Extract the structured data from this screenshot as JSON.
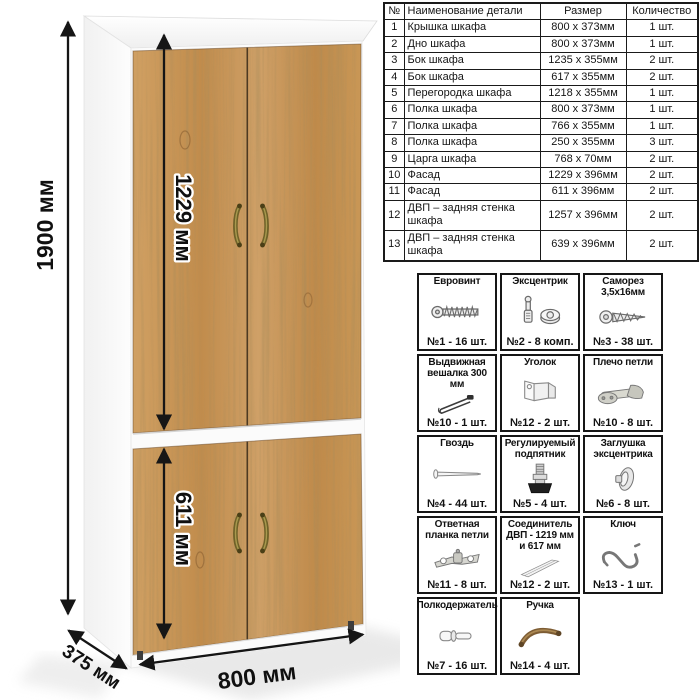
{
  "dimensions": {
    "height": "1900 мм",
    "width": "800 мм",
    "depth": "375 мм",
    "upper_facade": "1229 мм",
    "lower_facade": "611 мм"
  },
  "parts_table": {
    "headers": [
      "№",
      "Наименование детали",
      "Размер",
      "Количество"
    ],
    "rows": [
      {
        "num": "1",
        "name": "Крышка шкафа",
        "size": "800 х 373мм",
        "qty": "1 шт."
      },
      {
        "num": "2",
        "name": "Дно шкафа",
        "size": "800 х 373мм",
        "qty": "1 шт."
      },
      {
        "num": "3",
        "name": "Бок шкафа",
        "size": "1235 х 355мм",
        "qty": "2 шт."
      },
      {
        "num": "4",
        "name": "Бок шкафа",
        "size": "617 х 355мм",
        "qty": "2 шт."
      },
      {
        "num": "5",
        "name": "Перегородка шкафа",
        "size": "1218 х 355мм",
        "qty": "1 шт."
      },
      {
        "num": "6",
        "name": "Полка шкафа",
        "size": "800 х 373мм",
        "qty": "1 шт."
      },
      {
        "num": "7",
        "name": "Полка шкафа",
        "size": "766 х 355мм",
        "qty": "1 шт."
      },
      {
        "num": "8",
        "name": "Полка шкафа",
        "size": "250 х 355мм",
        "qty": "3 шт."
      },
      {
        "num": "9",
        "name": "Царга шкафа",
        "size": "768 х 70мм",
        "qty": "2 шт."
      },
      {
        "num": "10",
        "name": "Фасад",
        "size": "1229 х 396мм",
        "qty": "2 шт."
      },
      {
        "num": "11",
        "name": "Фасад",
        "size": "611 х 396мм",
        "qty": "2 шт."
      },
      {
        "num": "12",
        "name": "ДВП – задняя стенка шкафа",
        "size": "1257 х 396мм",
        "qty": "2 шт."
      },
      {
        "num": "13",
        "name": "ДВП – задняя стенка шкафа",
        "size": "639 х 396мм",
        "qty": "2 шт."
      }
    ]
  },
  "hardware": {
    "items": [
      {
        "name": "Евровинт",
        "count": "№1 - 16 шт.",
        "icon": "euro-screw-icon"
      },
      {
        "name": "Эксцентрик",
        "count": "№2 - 8 комп.",
        "icon": "cam-lock-icon"
      },
      {
        "name": "Саморез 3,5х16мм",
        "count": "№3 - 38 шт.",
        "icon": "self-tapping-screw-icon"
      },
      {
        "name": "Выдвижная вешалка 300 мм",
        "count": "№10 - 1 шт.",
        "icon": "pull-out-hanger-icon"
      },
      {
        "name": "Уголок",
        "count": "№12 - 2 шт.",
        "icon": "corner-bracket-icon"
      },
      {
        "name": "Плечо петли",
        "count": "№10 - 8 шт.",
        "icon": "hinge-arm-icon"
      },
      {
        "name": "Гвоздь",
        "count": "№4 - 44 шт.",
        "icon": "nail-icon"
      },
      {
        "name": "Регулируемый подпятник",
        "count": "№5 - 4 шт.",
        "icon": "adjustable-foot-icon"
      },
      {
        "name": "Заглушка эксцентрика",
        "count": "№6 - 8 шт.",
        "icon": "cam-cap-icon"
      },
      {
        "name": "Ответная планка петли",
        "count": "№11 - 8 шт.",
        "icon": "hinge-plate-icon"
      },
      {
        "name": "Соединитель ДВП - 1219 мм и 617 мм",
        "count": "№12 - 2 шт.",
        "icon": "hdf-connector-icon"
      },
      {
        "name": "Ключ",
        "count": "№13 - 1 шт.",
        "icon": "hex-key-icon"
      },
      {
        "name": "Полкодержатель",
        "count": "№7 - 16 шт.",
        "icon": "shelf-pin-icon"
      },
      {
        "name": "Ручка",
        "count": "№14 - 4 шт.",
        "icon": "handle-icon"
      }
    ]
  },
  "colors": {
    "wood": "#c79452",
    "wood_dark": "#a5743d",
    "carcass": "#fbfbfb",
    "handle_brass": "#6f6128",
    "line": "#151515"
  }
}
